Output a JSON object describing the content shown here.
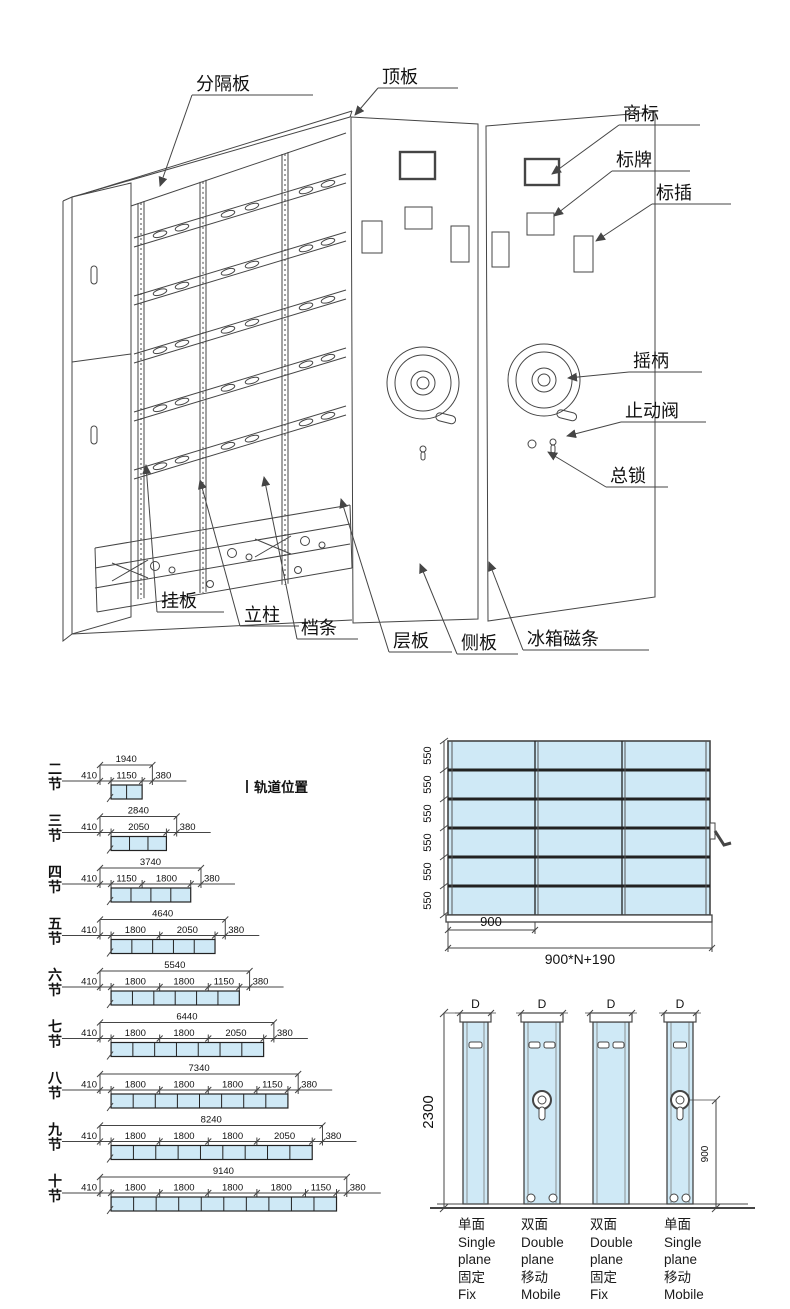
{
  "assembly": {
    "labels": {
      "fengeban": "分隔板",
      "dingban": "顶板",
      "shangbiao": "商标",
      "biaopai": "标牌",
      "biaocha": "标插",
      "yaobing": "摇柄",
      "zhidongfa": "止动阀",
      "zongsuo": "总锁",
      "guaban": "挂板",
      "lizhu": "立柱",
      "dangtiao": "档条",
      "cengban": "层板",
      "ceban": "侧板",
      "bingxiangcitiao": "冰箱磁条"
    }
  },
  "size_chart": {
    "track_note": "轨道位置",
    "rows": [
      {
        "label": "二节",
        "total": "1940",
        "segments": [
          "410",
          "1150",
          "380"
        ],
        "sections": 2
      },
      {
        "label": "三节",
        "total": "2840",
        "segments": [
          "410",
          "2050",
          "380"
        ],
        "sections": 3
      },
      {
        "label": "四节",
        "total": "3740",
        "segments": [
          "410",
          "1150",
          "1800",
          "380"
        ],
        "sections": 4
      },
      {
        "label": "五节",
        "total": "4640",
        "segments": [
          "410",
          "1800",
          "2050",
          "380"
        ],
        "sections": 5
      },
      {
        "label": "六节",
        "total": "5540",
        "segments": [
          "410",
          "1800",
          "1800",
          "1150",
          "380"
        ],
        "sections": 6
      },
      {
        "label": "七节",
        "total": "6440",
        "segments": [
          "410",
          "1800",
          "1800",
          "2050",
          "380"
        ],
        "sections": 7
      },
      {
        "label": "八节",
        "total": "7340",
        "segments": [
          "410",
          "1800",
          "1800",
          "1800",
          "1150",
          "380"
        ],
        "sections": 8
      },
      {
        "label": "九节",
        "total": "8240",
        "segments": [
          "410",
          "1800",
          "1800",
          "1800",
          "2050",
          "380"
        ],
        "sections": 9
      },
      {
        "label": "十节",
        "total": "9140",
        "segments": [
          "410",
          "1800",
          "1800",
          "1800",
          "1800",
          "1150",
          "380"
        ],
        "sections": 10
      }
    ]
  },
  "front_view": {
    "shelf_pitch_labels": [
      "550",
      "550",
      "550",
      "550",
      "550",
      "550"
    ],
    "bay_width": "900",
    "total_width": "900*N+190"
  },
  "side_view": {
    "height": "2300",
    "crank_height": "900",
    "depth_label": "D",
    "columns": [
      {
        "lines": [
          "单面",
          "Single",
          "plane",
          "固定",
          "Fix"
        ]
      },
      {
        "lines": [
          "双面",
          "Double",
          "plane",
          "移动",
          "Mobile"
        ]
      },
      {
        "lines": [
          "双面",
          "Double",
          "plane",
          "固定",
          "Fix"
        ]
      },
      {
        "lines": [
          "单面",
          "Single",
          "plane",
          "移动",
          "Mobile"
        ]
      }
    ]
  },
  "colors": {
    "panel_fill": "#cfe9f6",
    "line": "#454545",
    "text": "#111111"
  }
}
